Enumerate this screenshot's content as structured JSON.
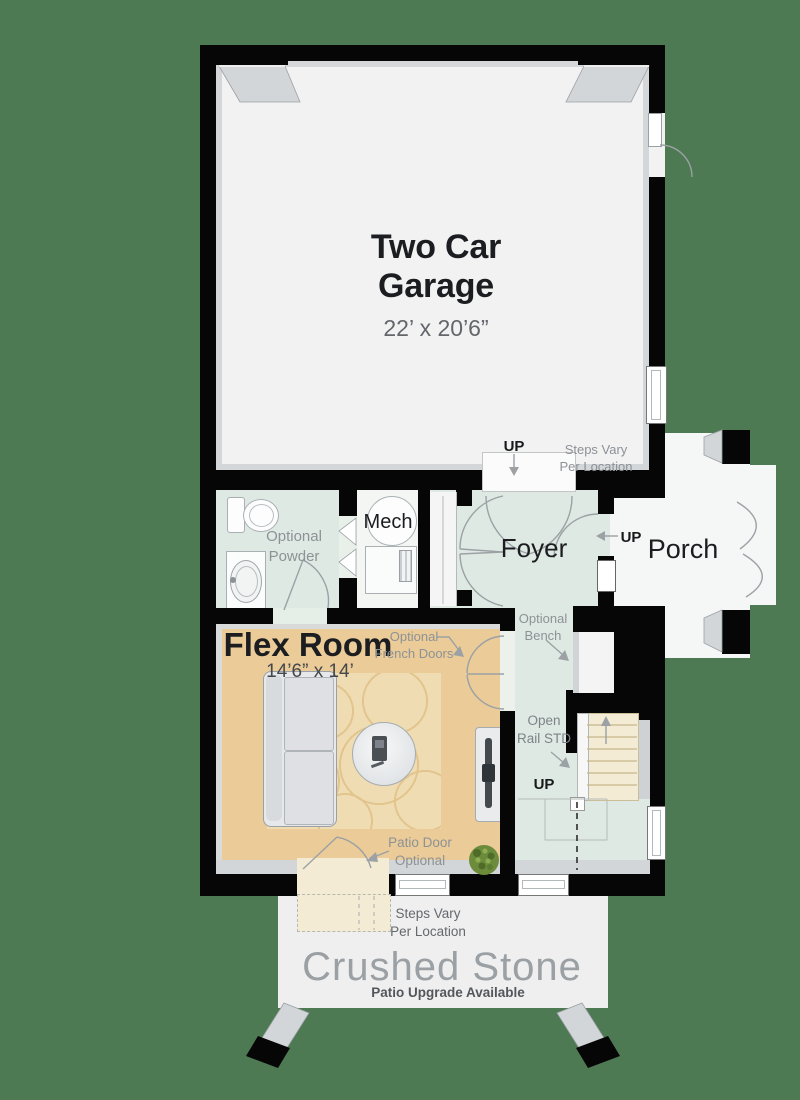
{
  "rooms": {
    "garage": {
      "name": "Two Car\nGarage",
      "dims": "22’ x 20’6”"
    },
    "powder": {
      "name": "Optional\nPowder"
    },
    "mech": {
      "name": "Mech"
    },
    "foyer": {
      "name": "Foyer"
    },
    "porch": {
      "name": "Porch"
    },
    "flex": {
      "name": "Flex Room",
      "dims": "14’6” x 14’"
    },
    "stone": {
      "name": "Crushed Stone",
      "subtitle": "Patio Upgrade Available"
    }
  },
  "annotations": {
    "up_garage_steps": "UP",
    "steps_vary_top": "Steps Vary\nPer Location",
    "up_porch": "UP",
    "optional_bench": "Optional\nBench",
    "open_rail": "Open\nRail STD",
    "up_stairs": "UP",
    "french_doors": "Optional\nFrench Doors",
    "patio_door": "Patio Door\nOptional",
    "steps_vary_bottom": "Steps Vary\nPer Location"
  },
  "colors": {
    "background": "#4d7953",
    "wall": "#060606",
    "garage_floor": "#f2f2f3",
    "mint_floor": "#dfe9e3",
    "tan_floor": "#ebcb97",
    "rug": "#efdcb2",
    "stair_cream": "#f3ebd3",
    "stone": "#efefef",
    "porch_floor": "#f5f6f6",
    "label_gray": "#8d9296",
    "text_dark": "#1b1d20"
  }
}
